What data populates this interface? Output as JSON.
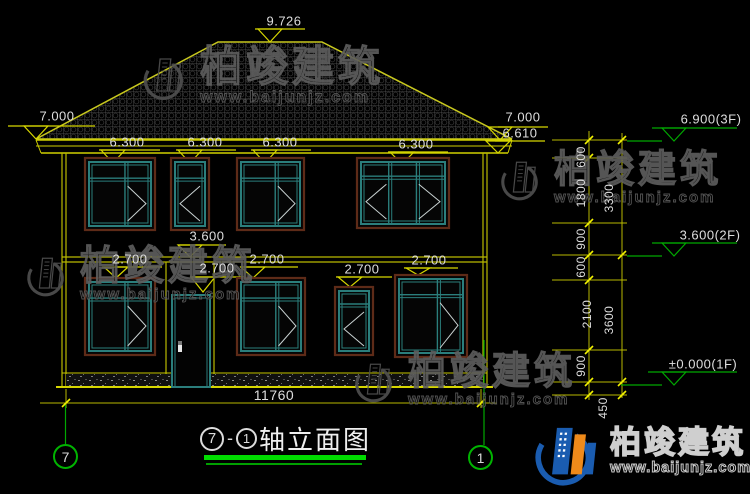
{
  "brand": {
    "name": "柏竣建筑",
    "url": "www.baijunjz.com"
  },
  "title": {
    "axis_from": "7",
    "separator": "-",
    "axis_to": "1",
    "label": "轴立面图"
  },
  "axis_bubbles": {
    "left": "7",
    "right": "1"
  },
  "colors": {
    "line_yellow": "#d6d600",
    "tick_yellow": "#f2f200",
    "cad_green": "#00a800",
    "title_green": "#00dc00",
    "frame_teal": "#2b7e7c",
    "frame_brown": "#5e2b18",
    "glass_line": "#c9d2d2",
    "text_light": "#dedede",
    "logo_blue": "#1a5cb0",
    "logo_orange": "#ef8a1a"
  },
  "dimensions": {
    "total_width": {
      "label": "11760",
      "cx": 274,
      "cy": 395,
      "line_y": 403,
      "x1": 40,
      "x2": 497
    },
    "facade_levels": [
      {
        "label": "9.726",
        "cx": 284,
        "cy": 21,
        "u": [
          255,
          305,
          29
        ],
        "t": [
          270,
          42
        ]
      },
      {
        "label": "7.000",
        "cx": 57,
        "cy": 116,
        "u": [
          8,
          95,
          126
        ],
        "t": [
          36,
          139
        ]
      },
      {
        "label": "7.000",
        "cx": 523,
        "cy": 117,
        "u": [
          498,
          548,
          127
        ],
        "t": [
          500,
          140
        ]
      },
      {
        "label": "6.610",
        "cx": 520,
        "cy": 133,
        "u": [
          495,
          545,
          141
        ],
        "t": [
          498,
          153
        ]
      },
      {
        "label": "6.300",
        "cx": 127,
        "cy": 142,
        "u": [
          99,
          160,
          150
        ],
        "t": [
          113,
          163
        ]
      },
      {
        "label": "6.300",
        "cx": 205,
        "cy": 142,
        "u": [
          176,
          236,
          150
        ],
        "t": [
          190,
          163
        ]
      },
      {
        "label": "6.300",
        "cx": 280,
        "cy": 142,
        "u": [
          251,
          311,
          150
        ],
        "t": [
          265,
          163
        ]
      },
      {
        "label": "6.300",
        "cx": 416,
        "cy": 144,
        "u": [
          388,
          448,
          152
        ],
        "t": [
          402,
          164
        ]
      },
      {
        "label": "3.600",
        "cx": 207,
        "cy": 236,
        "u": [
          178,
          226,
          245
        ],
        "t": [
          190,
          257
        ]
      },
      {
        "label": "2.700",
        "cx": 130,
        "cy": 259,
        "u": [
          102,
          162,
          267
        ],
        "t": [
          116,
          278
        ]
      },
      {
        "label": "2.700",
        "cx": 217,
        "cy": 268,
        "u": [
          190,
          244,
          277
        ],
        "t": [
          203,
          292
        ]
      },
      {
        "label": "2.700",
        "cx": 267,
        "cy": 259,
        "u": [
          240,
          298,
          267
        ],
        "t": [
          253,
          278
        ]
      },
      {
        "label": "2.700",
        "cx": 362,
        "cy": 269,
        "u": [
          336,
          392,
          277
        ],
        "t": [
          350,
          287
        ]
      },
      {
        "label": "2.700",
        "cx": 429,
        "cy": 260,
        "u": [
          404,
          458,
          268
        ],
        "t": [
          418,
          275
        ]
      }
    ],
    "right_levels": [
      {
        "label": "6.900(3F)",
        "cx": 711,
        "cy": 119,
        "u": [
          652,
          737,
          128
        ],
        "t": [
          674,
          141
        ],
        "lx": [
          627,
          662
        ]
      },
      {
        "label": "3.600(2F)",
        "cx": 710,
        "cy": 235,
        "u": [
          652,
          737,
          243
        ],
        "t": [
          674,
          256
        ],
        "lx": [
          627,
          662
        ]
      },
      {
        "label": "±0.000(1F)",
        "cx": 703,
        "cy": 364,
        "u": [
          648,
          737,
          372
        ],
        "t": [
          674,
          385
        ],
        "lx": [
          621,
          662
        ]
      }
    ],
    "vertical_dims": [
      {
        "label": "600",
        "x": 581,
        "y": 157
      },
      {
        "label": "1800",
        "x": 581,
        "y": 193
      },
      {
        "label": "900",
        "x": 581,
        "y": 239
      },
      {
        "label": "600",
        "x": 581,
        "y": 267
      },
      {
        "label": "2100",
        "x": 587,
        "y": 314
      },
      {
        "label": "900",
        "x": 581,
        "y": 366
      },
      {
        "label": "3300",
        "x": 609,
        "y": 198
      },
      {
        "label": "3600",
        "x": 609,
        "y": 320
      },
      {
        "label": "450",
        "x": 603,
        "y": 408
      }
    ]
  },
  "facade": {
    "windows": [
      {
        "floor": "2F",
        "x": 85,
        "y": 158,
        "w": 70,
        "h": 72,
        "divs": [
          0.58
        ],
        "transom": 0.28,
        "chevrons": [
          {
            "pane": [
              0.58,
              1
            ],
            "dir": "right"
          }
        ]
      },
      {
        "floor": "2F",
        "x": 171,
        "y": 158,
        "w": 38,
        "h": 72,
        "divs": [],
        "transom": 0.28,
        "chevrons": [
          {
            "pane": [
              0,
              1
            ],
            "dir": "left"
          }
        ]
      },
      {
        "floor": "2F",
        "x": 237,
        "y": 158,
        "w": 67,
        "h": 72,
        "divs": [
          0.58
        ],
        "transom": 0.28,
        "chevrons": [
          {
            "pane": [
              0.58,
              1
            ],
            "dir": "right"
          }
        ]
      },
      {
        "floor": "2F",
        "x": 357,
        "y": 158,
        "w": 92,
        "h": 70,
        "divs": [
          0.33,
          0.66
        ],
        "transom": 0.26,
        "chevrons": [
          {
            "pane": [
              0,
              0.33
            ],
            "dir": "left"
          },
          {
            "pane": [
              0.66,
              1
            ],
            "dir": "right"
          }
        ]
      },
      {
        "floor": "1F",
        "x": 85,
        "y": 278,
        "w": 70,
        "h": 77,
        "divs": [
          0.58
        ],
        "transom": 0.26,
        "chevrons": [
          {
            "pane": [
              0.58,
              1
            ],
            "dir": "right"
          }
        ]
      },
      {
        "floor": "1F",
        "x": 237,
        "y": 278,
        "w": 68,
        "h": 77,
        "divs": [
          0.58
        ],
        "transom": 0.26,
        "chevrons": [
          {
            "pane": [
              0.58,
              1
            ],
            "dir": "right"
          }
        ]
      },
      {
        "floor": "1F",
        "x": 335,
        "y": 287,
        "w": 38,
        "h": 68,
        "divs": [],
        "transom": 0.25,
        "chevrons": [
          {
            "pane": [
              0,
              1
            ],
            "dir": "left"
          }
        ]
      },
      {
        "floor": "1F",
        "x": 395,
        "y": 275,
        "w": 72,
        "h": 82,
        "divs": [
          0.6
        ],
        "transom": 0.24,
        "chevrons": [
          {
            "pane": [
              0.6,
              1
            ],
            "dir": "right"
          }
        ]
      }
    ],
    "door": {
      "x": 172,
      "y": 295,
      "w": 38,
      "h": 92
    }
  }
}
